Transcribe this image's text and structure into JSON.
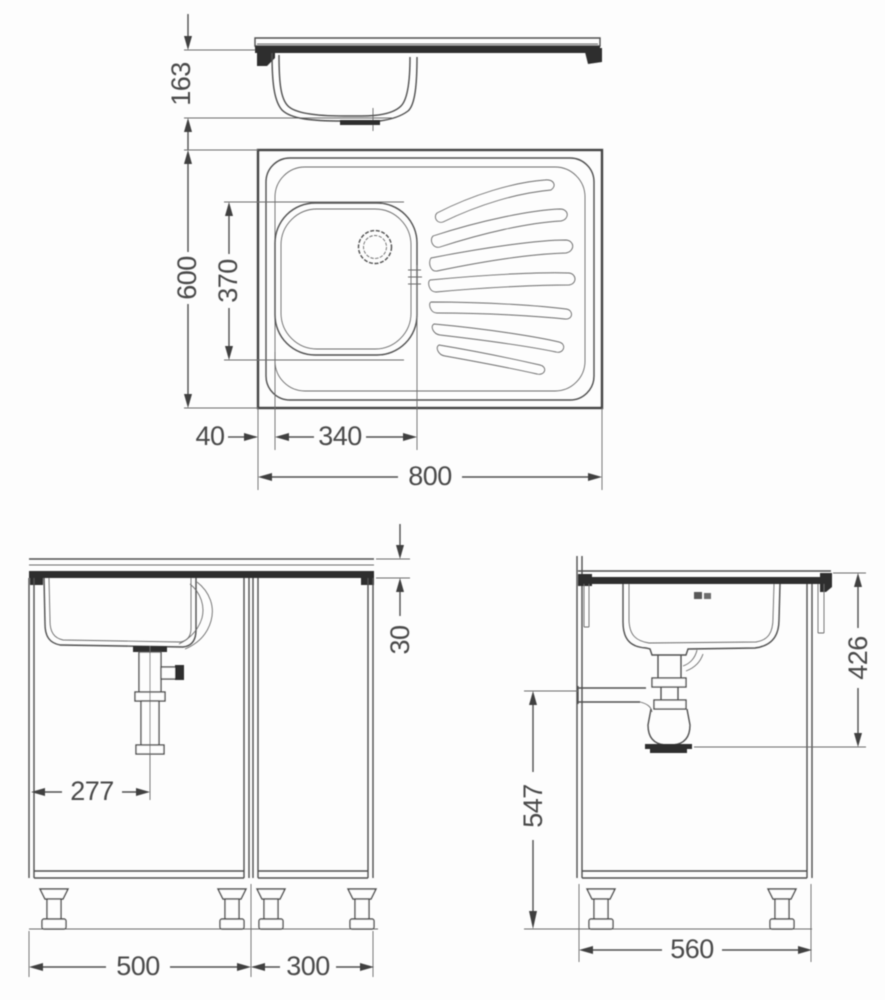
{
  "drawing": {
    "type": "technical-dimension-drawing",
    "subject": "kitchen sink unit with bowl, drainboard and base cabinets",
    "colors": {
      "line": "#4f4f4f",
      "dark_fill": "#2f2f2f",
      "background": "#fdfdfd"
    },
    "dims": {
      "side_profile_height": "163",
      "plan_depth": "600",
      "plan_bowl_depth": "370",
      "plan_bowl_offset_left": "40",
      "plan_bowl_width": "340",
      "plan_width": "800",
      "front_rim_height": "30",
      "front_drain_offset": "277",
      "front_left_unit_width": "500",
      "front_right_unit_width": "300",
      "side_drain_clearance": "426",
      "side_outlet_height": "547",
      "side_unit_depth": "560"
    }
  }
}
